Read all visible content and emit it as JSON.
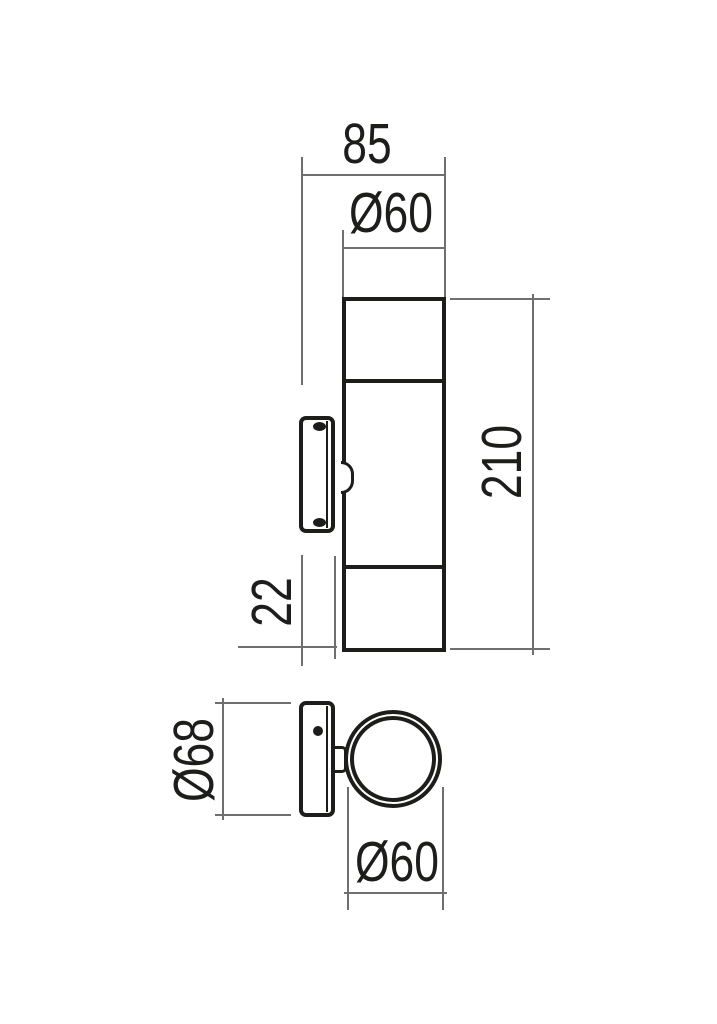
{
  "drawing": {
    "type": "technical-dimension-drawing",
    "labels": {
      "overall_depth": "85",
      "body_diameter_side": "Ø60",
      "overall_height": "210",
      "bracket_depth": "22",
      "bracket_plate_height": "Ø68",
      "body_diameter_front": "Ø60"
    },
    "colors": {
      "outline": "#1d1d1b",
      "dimension_line": "#6f6f6f",
      "background": "#ffffff"
    }
  }
}
